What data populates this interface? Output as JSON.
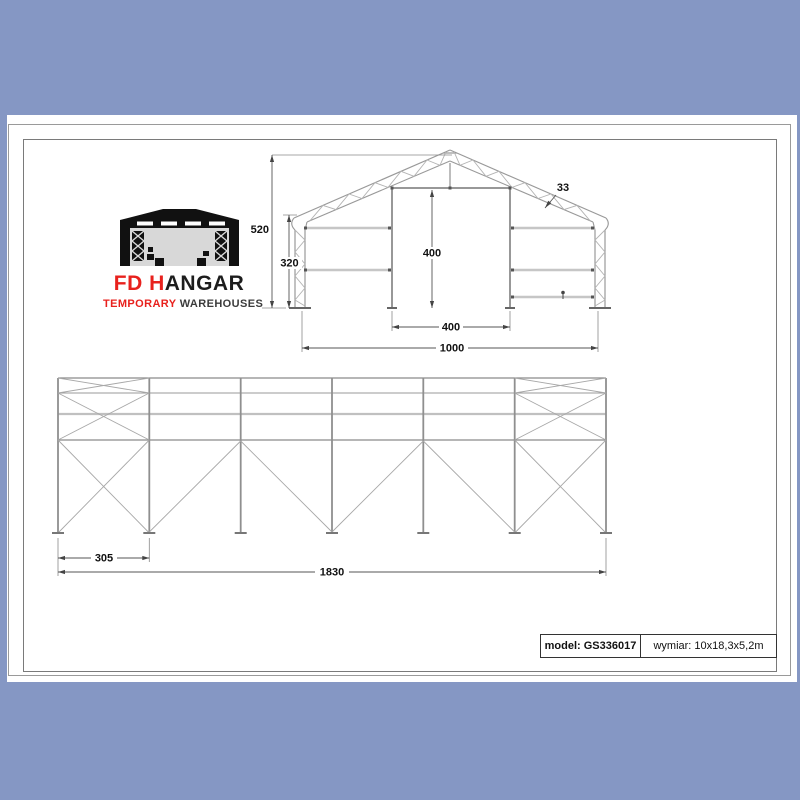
{
  "window": {
    "background_color": "#8597c4",
    "paper_color": "#ffffff"
  },
  "logo": {
    "accent_color": "#e8211d",
    "brand_red_part": "FD H",
    "brand_black_part": "ANGAR",
    "tagline_red_part": "TEMPORARY",
    "tagline_gray_part": " WAREHOUSES"
  },
  "front_elevation": {
    "dims": {
      "total_height": "520",
      "eave_height": "320",
      "door_height": "400",
      "door_width": "400",
      "total_width": "1000",
      "truss_depth": "33"
    }
  },
  "side_elevation": {
    "dims": {
      "first_bay_width": "305",
      "total_length": "1830"
    }
  },
  "title_block": {
    "model": "model: GS336017",
    "size": "wymiar: 10x18,3x5,2m"
  }
}
